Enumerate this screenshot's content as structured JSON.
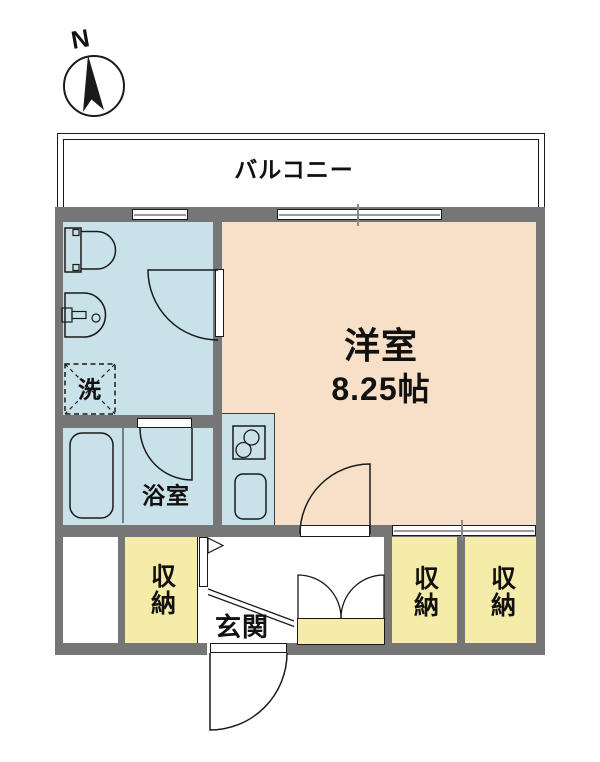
{
  "colors": {
    "wall": "#767676",
    "wet": "#c9e2ea",
    "living": "#f7e0c7",
    "storage": "#f6ecaa",
    "line": "#1a1a1a"
  },
  "compass": {
    "north_label": "N"
  },
  "rooms": {
    "balcony": {
      "label": "バルコニー"
    },
    "western_room": {
      "label": "洋室",
      "size": "8.25帖"
    },
    "bathroom": {
      "label": "浴室"
    },
    "washroom": {
      "washer_label": "洗"
    },
    "entrance": {
      "label": "玄関"
    },
    "storage_1": {
      "label": "収納"
    },
    "storage_2": {
      "label": "収納"
    },
    "storage_3": {
      "label": "収納"
    }
  }
}
